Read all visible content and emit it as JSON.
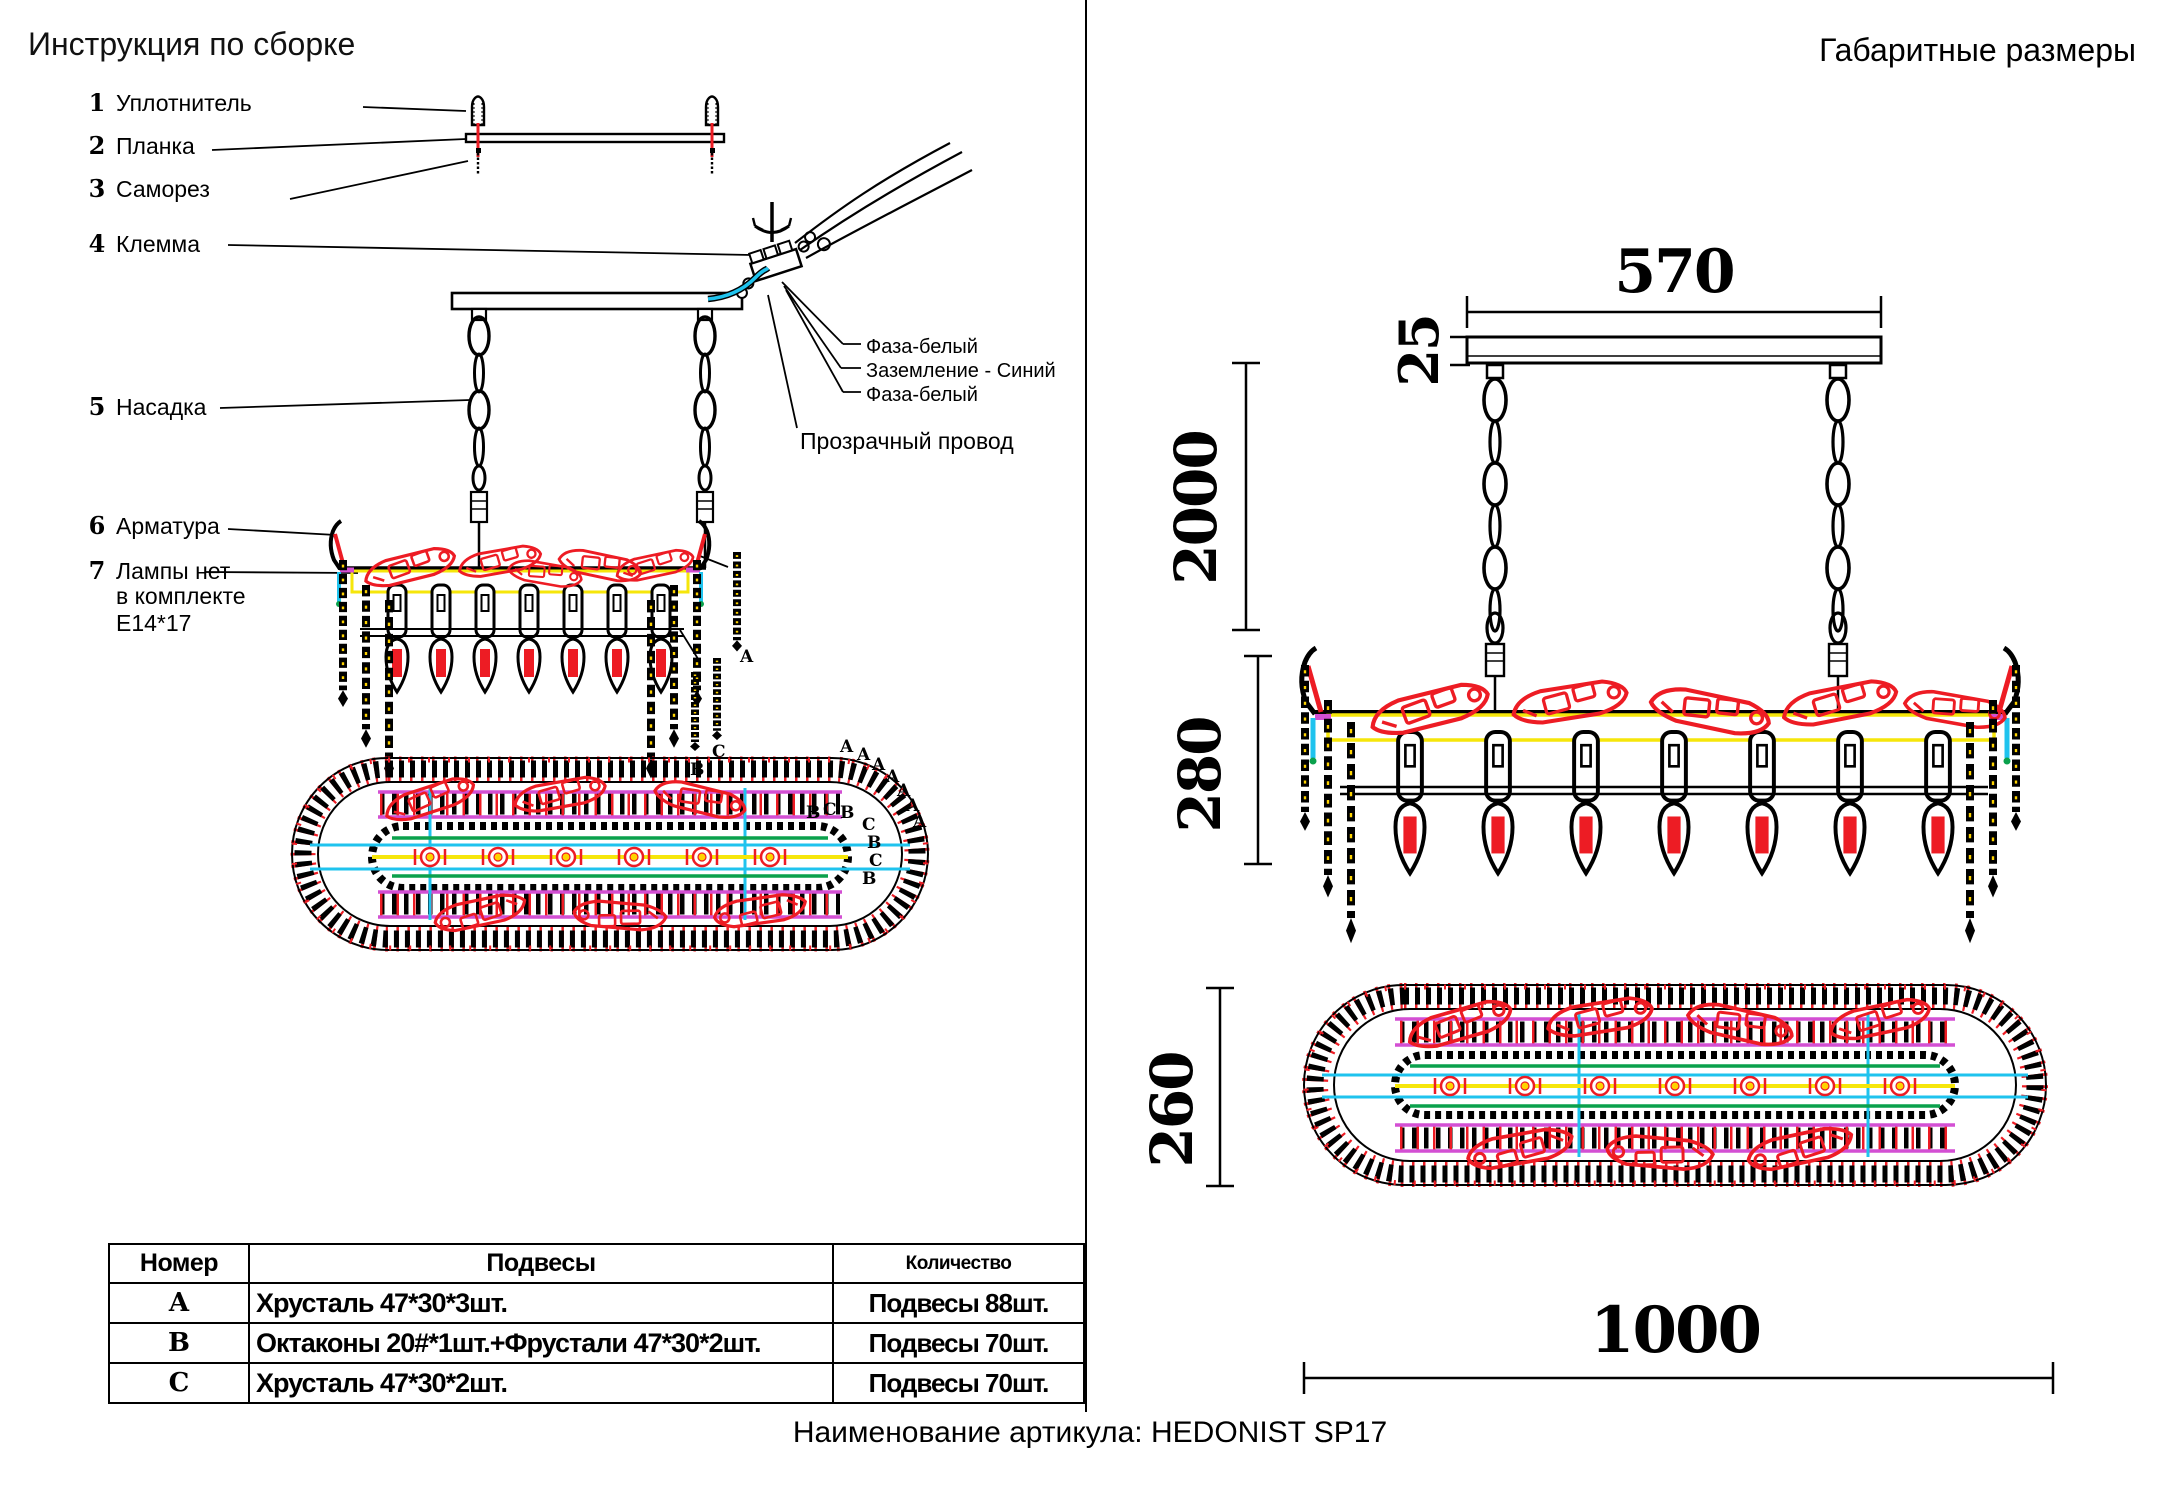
{
  "left_panel": {
    "title": "Инструкция по сборке",
    "parts": [
      {
        "num": "1",
        "label": "Уплотнитель"
      },
      {
        "num": "2",
        "label": "Планка"
      },
      {
        "num": "3",
        "label": "Саморез"
      },
      {
        "num": "4",
        "label": "Клемма"
      },
      {
        "num": "5",
        "label": "Насадка"
      },
      {
        "num": "6",
        "label": "Арматура"
      },
      {
        "num": "7",
        "label": "Лампы нет"
      }
    ],
    "part7_lines": [
      "в комплекте",
      "Е14*17"
    ],
    "wires": {
      "phase_top": "Фаза-белый",
      "ground": "Заземление - Синий",
      "phase_bottom": "Фаза-белый",
      "transparent": "Прозрачный провод"
    },
    "letters": {
      "a": "A",
      "b": "B",
      "c": "C"
    }
  },
  "table": {
    "headers": [
      "Номер",
      "Подвесы",
      "Количество"
    ],
    "rows": [
      {
        "num": "A",
        "pendants": "Хрусталь 47*30*3шт.",
        "qty": "Подвесы 88шт."
      },
      {
        "num": "B",
        "pendants": "Октаконы 20#*1шт.+Фрустали 47*30*2шт.",
        "qty": "Подвесы 70шт."
      },
      {
        "num": "C",
        "pendants": "Хрусталь 47*30*2шт.",
        "qty": "Подвесы 70шт."
      }
    ]
  },
  "right_panel": {
    "title": "Габаритные размеры",
    "dimensions": {
      "canopy_width": "570",
      "canopy_height": "25",
      "chain_length": "2000",
      "body_height": "280",
      "oval_length": "1000",
      "oval_width": "260"
    }
  },
  "footer": {
    "article_caption": "Наименование артикула: HEDONIST SP17"
  },
  "colors": {
    "red": "#ed1c24",
    "yellow": "#f6e60a",
    "cyan": "#1fc3ee",
    "magenta": "#d34fd3",
    "green": "#0aa14c",
    "black": "#000000"
  }
}
